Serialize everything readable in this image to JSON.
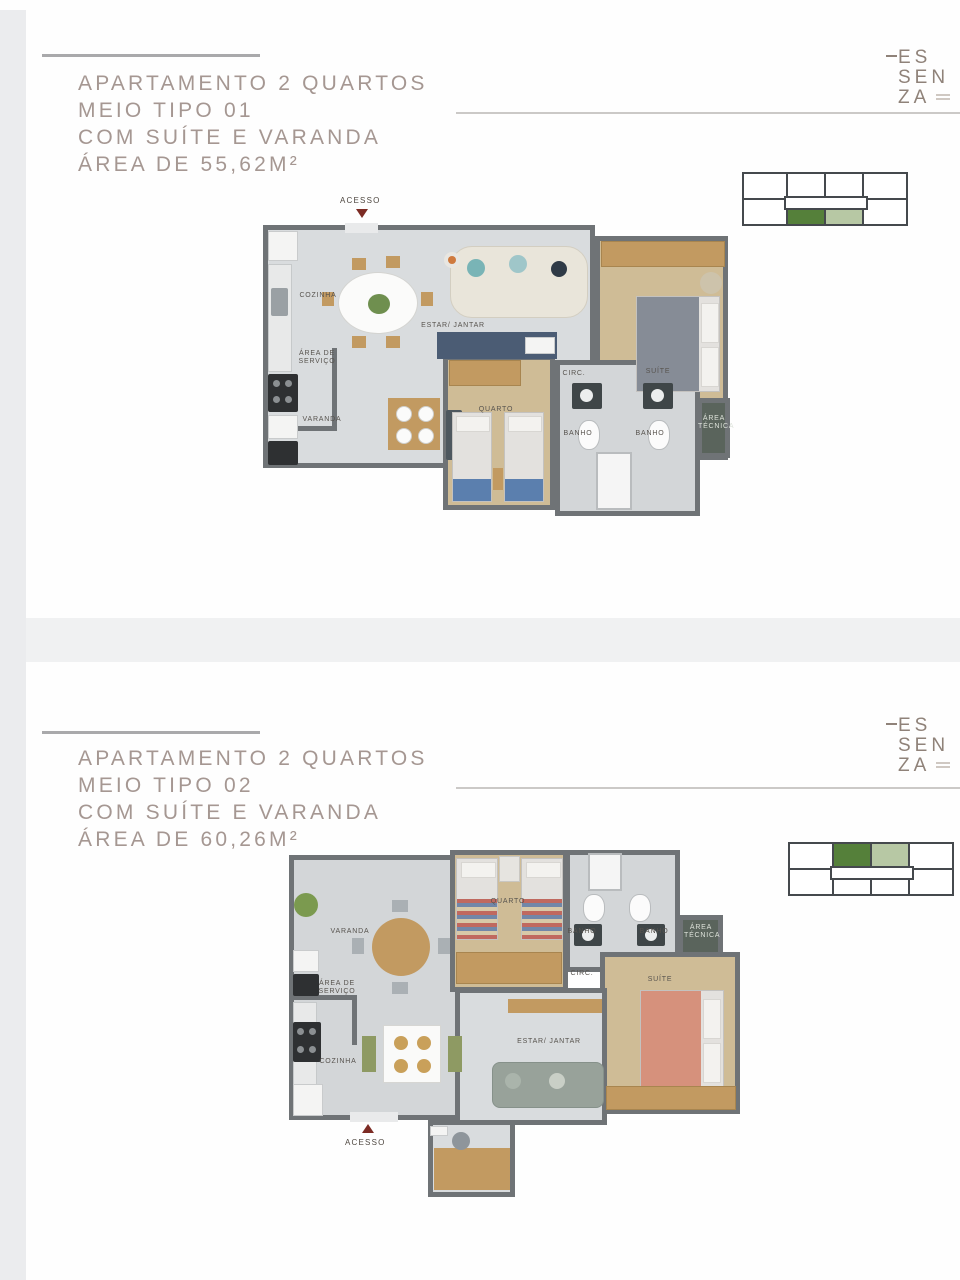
{
  "brand": {
    "logo_lines": [
      "ES",
      "SEN",
      "ZA"
    ]
  },
  "colors": {
    "title": "#a59792",
    "logo": "#8f8279",
    "wall": "#6f7376",
    "floor_tile": "#d9dcde",
    "floor_wood": "#cfbc96",
    "keyplan_dark_green": "#55803a",
    "keyplan_light_green": "#b7c8a4",
    "access_red": "#7c2b24"
  },
  "sections": [
    {
      "title_lines": [
        "APARTAMENTO 2 QUARTOS",
        "MEIO TIPO 01",
        "COM SUÍTE E VARANDA",
        "ÁREA DE 55,62M²"
      ],
      "access_label": "ACESSO",
      "room_labels": {
        "cozinha": "COZINHA",
        "estar_jantar": "ESTAR/ JANTAR",
        "area_servico": "ÁREA DE SERVIÇO",
        "varanda": "VARANDA",
        "quarto": "QUARTO",
        "circ": "CIRC.",
        "suite": "SUÍTE",
        "banho1": "BANHO",
        "banho2": "BANHO",
        "area_tecnica": "ÁREA TÉCNICA"
      }
    },
    {
      "title_lines": [
        "APARTAMENTO 2 QUARTOS",
        "MEIO TIPO 02",
        "COM SUÍTE E VARANDA",
        "ÁREA DE 60,26M²"
      ],
      "access_label": "ACESSO",
      "room_labels": {
        "cozinha": "COZINHA",
        "estar_jantar": "ESTAR/ JANTAR",
        "area_servico": "ÁREA DE SERVIÇO",
        "varanda": "VARANDA",
        "quarto": "QUARTO",
        "circ": "CIRC.",
        "suite": "SUÍTE",
        "banho1": "BANHO",
        "banho2": "BANHO",
        "area_tecnica": "ÁREA TÉCNICA"
      }
    }
  ]
}
